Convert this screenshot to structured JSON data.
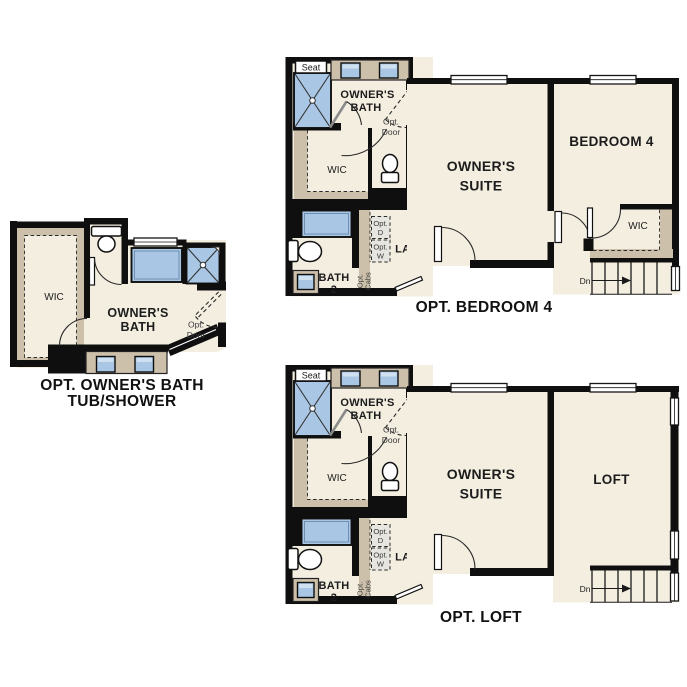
{
  "colors": {
    "background": "#ffffff",
    "wall": "#0f0f0f",
    "floor": "#f4eee1",
    "carpet": "#ccc0aa",
    "fixture_blue": "#a9c6e4",
    "fixture_blue_light": "#cfe0f1",
    "text": "#1c1c1c"
  },
  "bath_wing": {
    "seat": "Seat",
    "owners_bath_line1": "OWNER'S",
    "owners_bath_line2": "BATH",
    "opt_door_line1": "Opt.",
    "opt_door_line2": "Door",
    "wic_label": "WIC",
    "bath2_line1": "BATH",
    "bath2_line2": "2",
    "laundry_label": "LAUN",
    "opt_d_line1": "Opt.",
    "opt_d_line2": "D",
    "opt_w_line1": "Opt.",
    "opt_w_line2": "W",
    "opt_cabs_line1": "Opt.",
    "opt_cabs_line2": "Cabs"
  },
  "suite_area": {
    "owners_suite_line1": "OWNER'S",
    "owners_suite_line2": "SUITE",
    "stairs_dn": "Dn"
  },
  "plan_bedroom4": {
    "bedroom_label": "BEDROOM 4",
    "wic_label": "WIC",
    "title": "OPT. BEDROOM 4"
  },
  "plan_loft": {
    "loft_label": "LOFT",
    "title": "OPT. LOFT"
  },
  "plan_tub_shower": {
    "wic_label": "WIC",
    "owners_bath_line1": "OWNER'S",
    "owners_bath_line2": "BATH",
    "opt_door_line1": "Opt.",
    "opt_door_line2": "Door",
    "title_line1": "OPT. OWNER'S BATH",
    "title_line2": "TUB/SHOWER"
  }
}
